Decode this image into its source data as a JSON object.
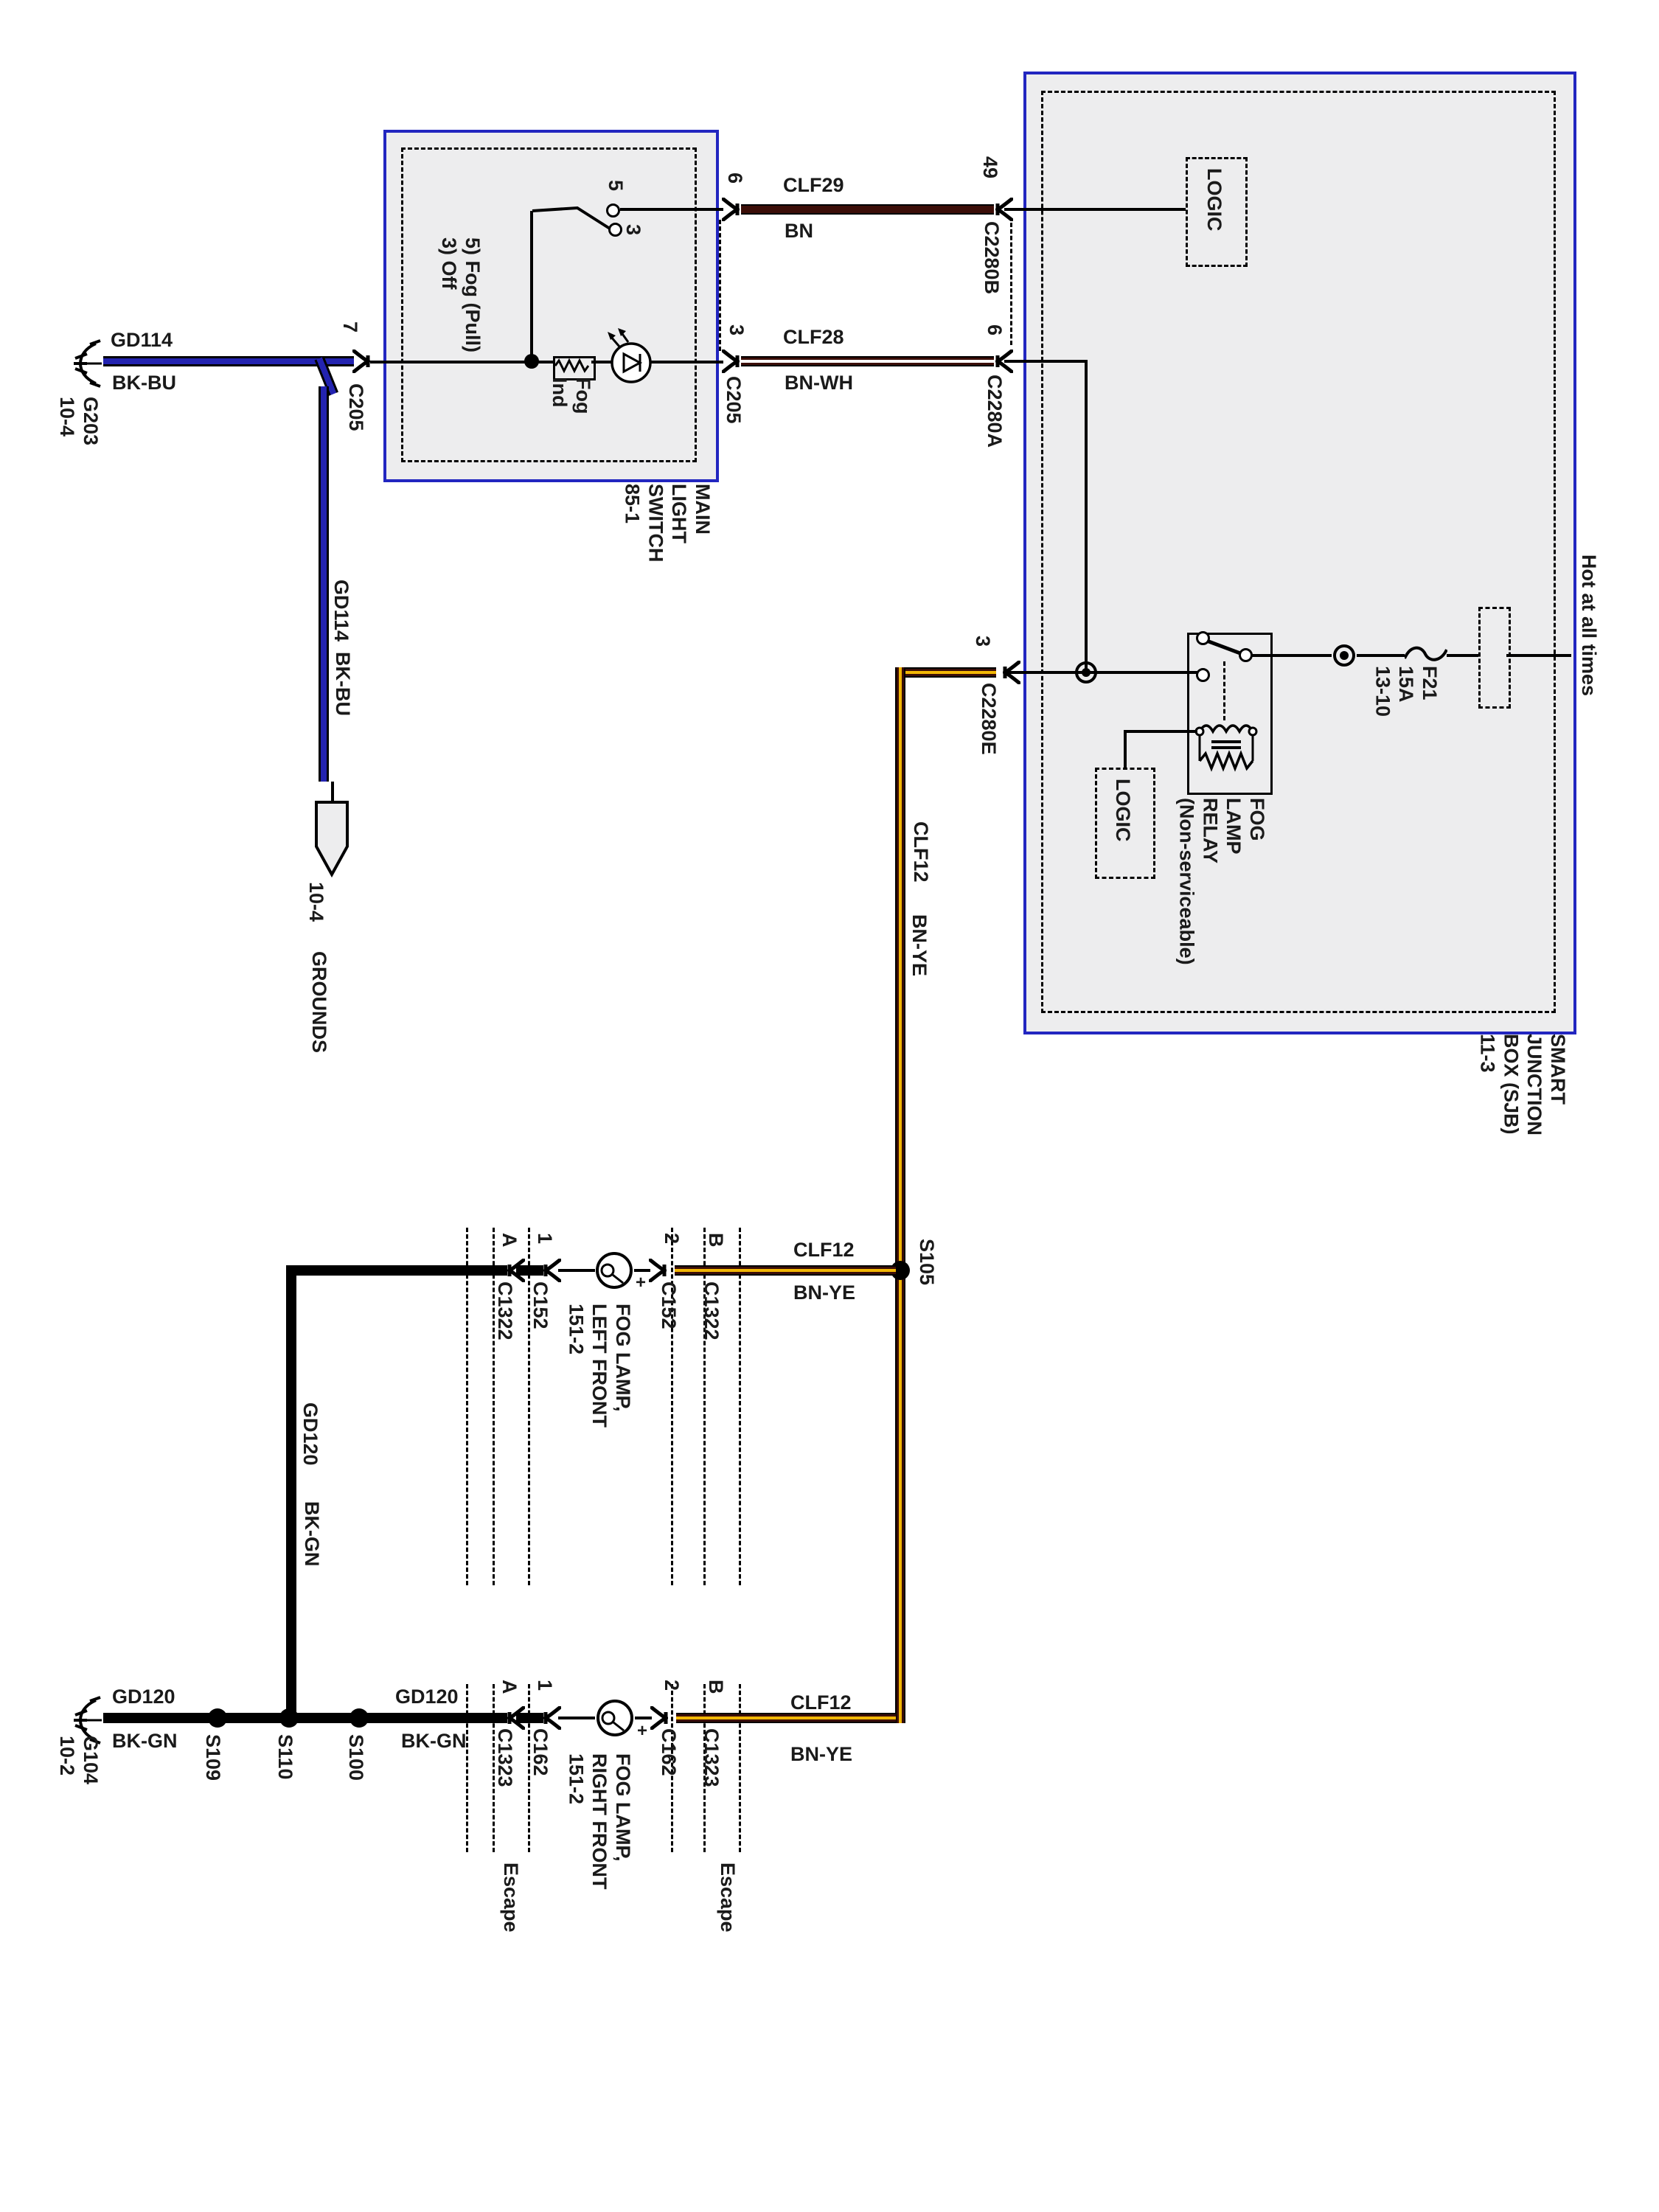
{
  "title": "Fog lamp circuit wiring diagram",
  "colors": {
    "box_border_blue": "#2226c0",
    "box_fill_gray": "#ededee",
    "wire_brown": "#3c0e08",
    "wire_yellow": "#f2b705",
    "wire_blue": "#2323b0",
    "wire_black": "#000000",
    "wire_white": "#ffffff",
    "text": "#1a1a1a"
  },
  "t": {
    "gd114": "GD114",
    "bkbu": "BK-BU",
    "g203_block": "G203\n10-4",
    "offpage_ref": "10-4",
    "offpage_grounds": "GROUNDS",
    "clf29": "CLF29",
    "bn": "BN",
    "clf28": "CLF28",
    "bnwh": "BN-WH",
    "clf12": "CLF12",
    "bnye": "BN-YE",
    "gd120": "GD120",
    "bkgn": "BK-GN",
    "g104_block": "G104\n10-2",
    "pin7": "7",
    "pin6": "6",
    "pin5": "5",
    "pin3": "3",
    "pin49": "49",
    "pin1": "1",
    "pin2": "2",
    "pinA": "A",
    "pinB": "B",
    "c205": "C205",
    "c2280b": "C2280B",
    "c2280a": "C2280A",
    "c2280e": "C2280E",
    "c1322": "C1322",
    "c152": "C152",
    "c1323": "C1323",
    "c162": "C162",
    "s105": "S105",
    "s109": "S109",
    "s110": "S110",
    "s100": "S100",
    "main_light_switch": "MAIN\nLIGHT\nSWITCH\n85-1",
    "switch_positions": "5) Fog (Pull)\n3) Off",
    "fog_ind": "Fog\nInd",
    "sjb_title": "SMART\nJUNCTION\nBOX (SJB)\n11-3",
    "logic": "LOGIC",
    "relay": "FOG\nLAMP\nRELAY\n(Non-serviceable)",
    "fuse": "F21\n15A\n13-10",
    "hot": "Hot at all times",
    "lamp_left": "FOG LAMP,\nLEFT FRONT\n151-2",
    "lamp_right": "FOG LAMP,\nRIGHT FRONT\n151-2",
    "plus": "+",
    "escape": "Escape"
  }
}
